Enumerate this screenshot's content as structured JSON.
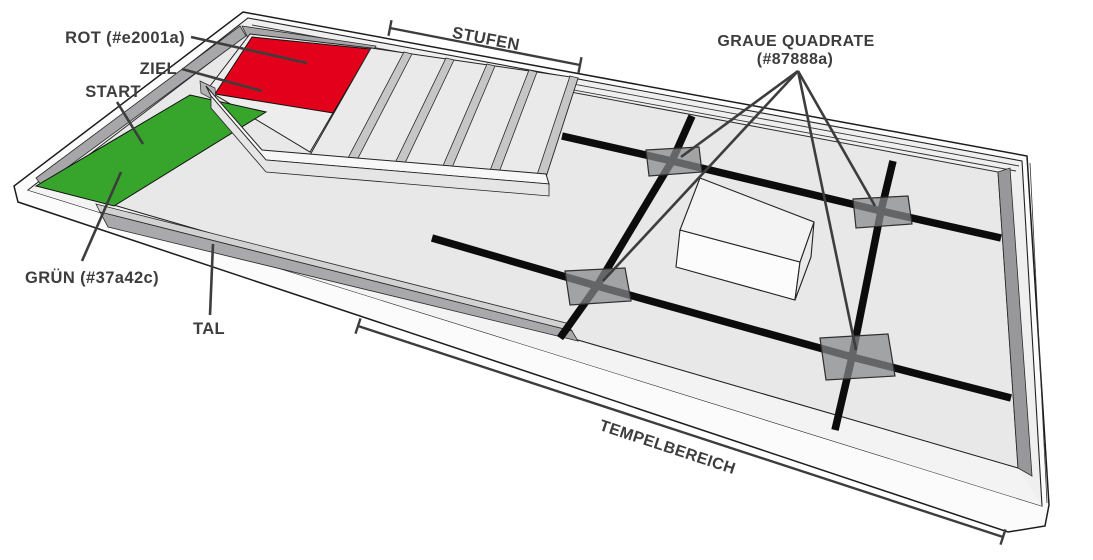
{
  "diagram": {
    "type": "isometric-temple-area-map",
    "background": "#ffffff",
    "labels": {
      "rot": "ROT (#e2001a)",
      "ziel": "ZIEL",
      "start": "START",
      "gruen": "GRÜN (#37a42c)",
      "tal": "TAL",
      "stufen": "STUFEN",
      "graue_quadrate_line1": "GRAUE QUADRATE",
      "graue_quadrate_line2": "(#87888a)",
      "tempelbereich": "TEMPELBEREICH"
    },
    "colors": {
      "rot": "#e2001a",
      "gruen": "#37a42c",
      "graue_quadrate": "#87888a",
      "pfad": "#0c0c0c",
      "text": "#3d3d3d"
    },
    "graue_quadrate_anzahl": 4
  }
}
